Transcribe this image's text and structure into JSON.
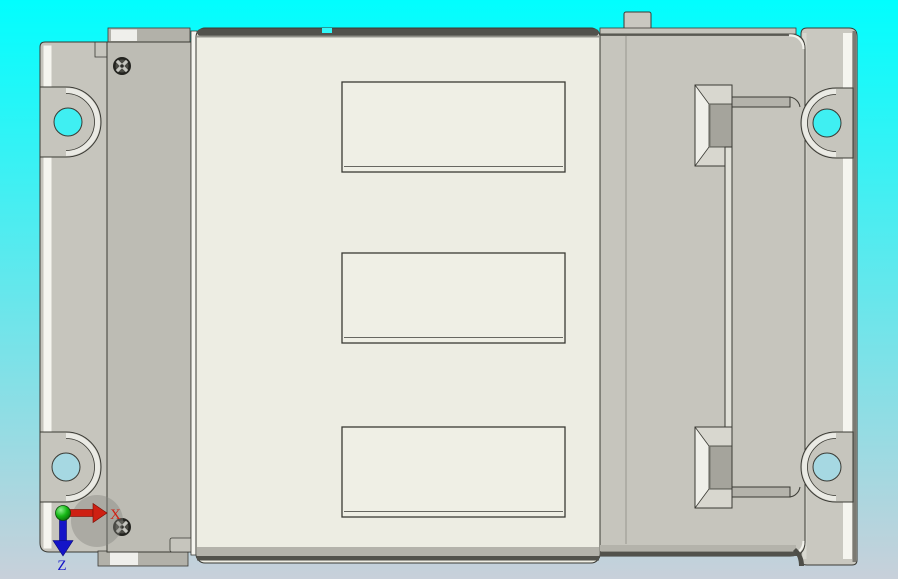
{
  "viewport": {
    "type": "cad-3d-view",
    "view_orientation": "top"
  },
  "triad": {
    "x_axis": {
      "label": "X"
    },
    "z_axis": {
      "label": "Z"
    }
  },
  "colors": {
    "bg_top": "#01FEFE",
    "bg_bottom": "#C8D0DA",
    "outline": "#3A3A34",
    "plate": "#C6C5BD",
    "strip": "#BDBCB4",
    "panel": "#EDEDE3",
    "recess": "#EFEFE5",
    "right_plate": "#C9C8C0",
    "bevel_dark": "#52524C",
    "bevel_mid": "#B4B3AB",
    "highlight": "#F5F5EF",
    "foot": "#B2B1A9",
    "foot_hi": "#EFEFEB",
    "pocket_face": "#A5A49C",
    "chamfer_light": "#EFEFE9",
    "chamfer_mid": "#D8D7CF",
    "groove": "#B4B3AB",
    "hole_top": "#3FEFF2",
    "hole_bottom": "#A6D8E2",
    "screw_dark": "#23231F",
    "x_color": "#CE2013",
    "z_color": "#1414C8",
    "origin_green": "#16B916"
  }
}
